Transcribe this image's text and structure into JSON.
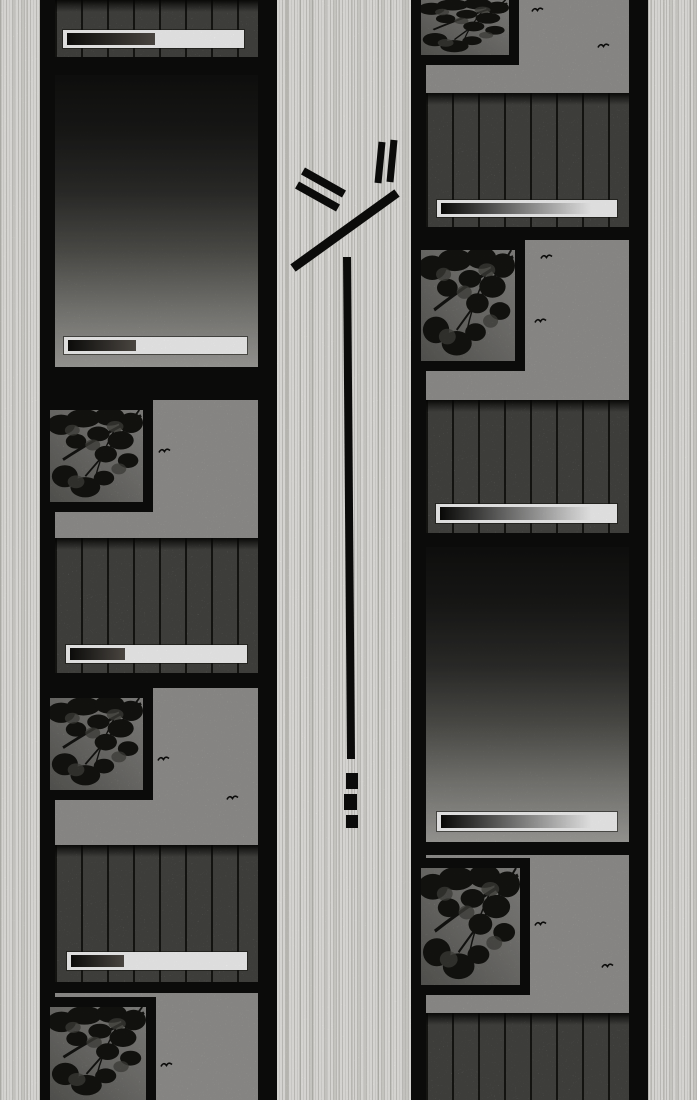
{
  "page": {
    "width": 697,
    "height": 1100,
    "kind": "manga-page",
    "paper_color": "#f5f4f0",
    "ink_color": "#0d0d0c"
  },
  "palette": {
    "sky": "#c7c6c2",
    "plank": "#90908a",
    "caption_bg": "#ffffff",
    "caption_left_from": "#0e0e0c",
    "caption_left_to": "#55504a",
    "caption_right_from": "#0a0a08",
    "caption_right_to": "#ffffff",
    "foliage": "#1d1d19",
    "gradient_stops": [
      "#161614",
      "#232321",
      "#3c3c39",
      "#6b6b65",
      "#a5a59f",
      "#d8d7d2"
    ]
  },
  "strips": [
    {
      "name": "film-strip-left",
      "x": 40,
      "w": 237,
      "ix": 55,
      "iw": 203,
      "panels": [
        {
          "name": "panel-fence-strip",
          "type": "plank",
          "y": 0,
          "h": 57,
          "plank_top": null,
          "tree": null,
          "birds": [],
          "caption": {
            "x": 63,
            "y": 30,
            "w": 181,
            "h": 18,
            "fill": 0.51,
            "style": "left"
          }
        },
        {
          "name": "panel-dusk-gradient-1",
          "type": "gradient",
          "y": 75,
          "h": 292,
          "plank_top": null,
          "tree": null,
          "birds": [],
          "caption": {
            "x": 64,
            "y": 337,
            "w": 183,
            "h": 17,
            "fill": 0.39,
            "style": "left"
          }
        },
        {
          "name": "panel-tree-window-1",
          "type": "scene",
          "y": 400,
          "h": 273,
          "plank_top": 538,
          "tree": {
            "x": 40,
            "y": 400,
            "w": 113,
            "h": 112,
            "cut": ""
          },
          "birds": [
            [
              158,
              446
            ]
          ],
          "caption": {
            "x": 66,
            "y": 645,
            "w": 181,
            "h": 18,
            "fill": 0.32,
            "style": "left"
          }
        },
        {
          "name": "panel-tree-window-2",
          "type": "scene",
          "y": 688,
          "h": 294,
          "plank_top": 845,
          "tree": {
            "x": 40,
            "y": 688,
            "w": 113,
            "h": 112,
            "cut": ""
          },
          "birds": [
            [
              157,
              754
            ],
            [
              226,
              793
            ]
          ],
          "caption": {
            "x": 67,
            "y": 952,
            "w": 180,
            "h": 18,
            "fill": 0.31,
            "style": "left"
          }
        },
        {
          "name": "panel-tree-window-3",
          "type": "scene",
          "y": 993,
          "h": 107,
          "plank_top": null,
          "tree": {
            "x": 40,
            "y": 997,
            "w": 116,
            "h": 103,
            "cut": "cut-bottom"
          },
          "birds": [
            [
              160,
              1060
            ]
          ],
          "caption": null
        }
      ]
    },
    {
      "name": "film-strip-right",
      "x": 411,
      "w": 237,
      "ix": 426,
      "iw": 203,
      "panels": [
        {
          "name": "panel-tree-window-4",
          "type": "scene",
          "y": 0,
          "h": 227,
          "plank_top": 93,
          "tree": {
            "x": 411,
            "y": 0,
            "w": 108,
            "h": 65,
            "cut": "cut-top"
          },
          "birds": [
            [
              531,
              5
            ],
            [
              597,
              41
            ]
          ],
          "caption": {
            "x": 437,
            "y": 200,
            "w": 180,
            "h": 17,
            "fill": 0.87,
            "style": "right"
          }
        },
        {
          "name": "panel-tree-window-5",
          "type": "scene",
          "y": 240,
          "h": 293,
          "plank_top": 400,
          "tree": {
            "x": 411,
            "y": 240,
            "w": 114,
            "h": 131,
            "cut": ""
          },
          "birds": [
            [
              540,
              252
            ],
            [
              534,
              316
            ]
          ],
          "caption": {
            "x": 436,
            "y": 504,
            "w": 181,
            "h": 19,
            "fill": 0.87,
            "style": "right"
          }
        },
        {
          "name": "panel-dusk-gradient-2",
          "type": "gradient",
          "y": 547,
          "h": 295,
          "plank_top": null,
          "tree": null,
          "birds": [],
          "caption": {
            "x": 437,
            "y": 812,
            "w": 180,
            "h": 19,
            "fill": 0.87,
            "style": "right"
          }
        },
        {
          "name": "panel-tree-window-6",
          "type": "scene",
          "y": 855,
          "h": 245,
          "plank_top": 1013,
          "tree": {
            "x": 411,
            "y": 858,
            "w": 119,
            "h": 137,
            "cut": ""
          },
          "birds": [
            [
              534,
              919
            ],
            [
              601,
              961
            ]
          ],
          "caption": null
        }
      ]
    }
  ],
  "marks": {
    "name": "impact-speed-marks",
    "strokes": [
      {
        "kind": "line",
        "x1": 303,
        "y1": 171,
        "x2": 344,
        "y2": 194,
        "w": 8
      },
      {
        "kind": "line",
        "x1": 297,
        "y1": 185,
        "x2": 338,
        "y2": 208,
        "w": 8
      },
      {
        "kind": "line",
        "x1": 382,
        "y1": 142,
        "x2": 378,
        "y2": 183,
        "w": 7
      },
      {
        "kind": "line",
        "x1": 394,
        "y1": 140,
        "x2": 390,
        "y2": 182,
        "w": 7
      },
      {
        "kind": "line",
        "x1": 293,
        "y1": 268,
        "x2": 397,
        "y2": 193,
        "w": 9
      },
      {
        "kind": "line",
        "x1": 347,
        "y1": 257,
        "x2": 351,
        "y2": 759,
        "w": 8
      },
      {
        "kind": "dot",
        "x": 346,
        "y": 773,
        "w": 12,
        "h": 16
      },
      {
        "kind": "dot",
        "x": 344,
        "y": 794,
        "w": 13,
        "h": 16
      },
      {
        "kind": "dot",
        "x": 346,
        "y": 815,
        "w": 12,
        "h": 13
      }
    ]
  }
}
